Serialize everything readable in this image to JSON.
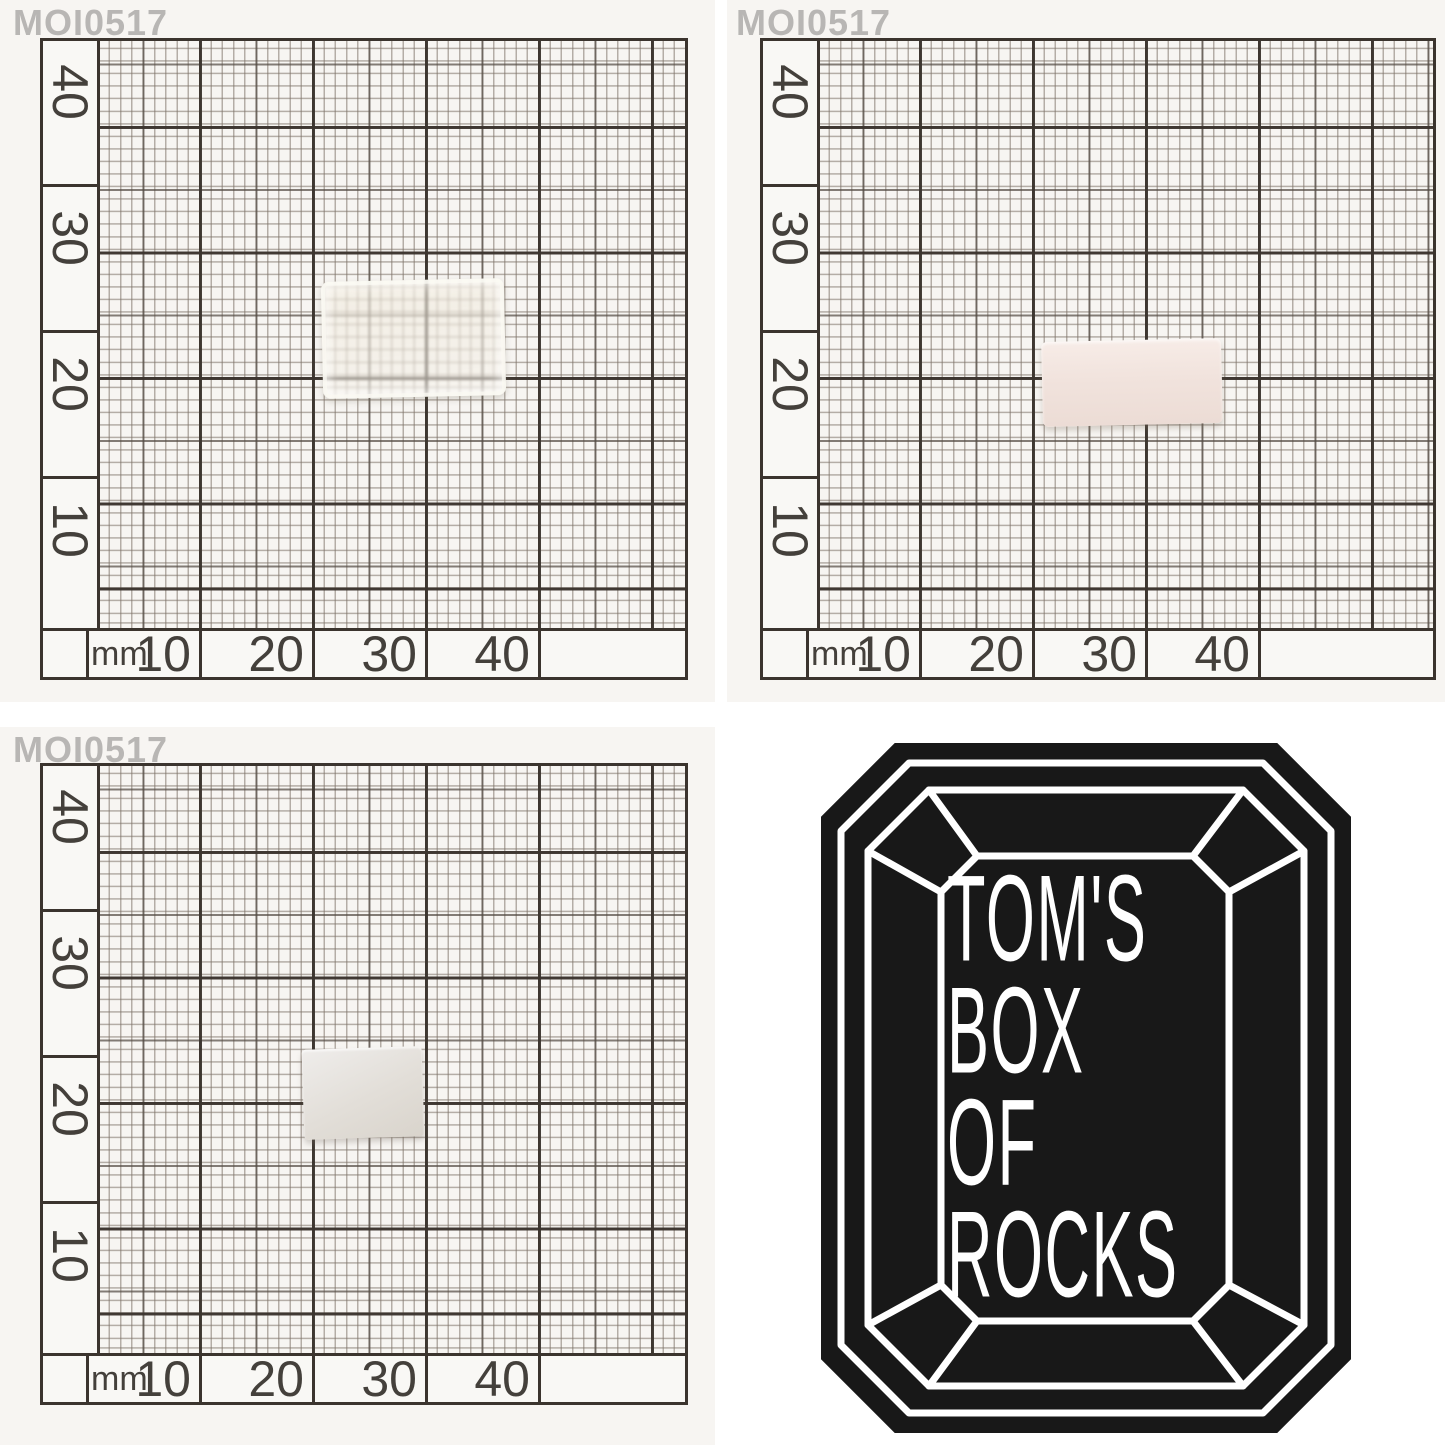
{
  "collage": {
    "panels": [
      {
        "position": "top-left",
        "label": "MOI0517",
        "specimen": {
          "view": "top view, translucent polished sheet",
          "color": "#efe8da"
        }
      },
      {
        "position": "top-right",
        "label": "MOI0517",
        "specimen": {
          "view": "top view, opaque pinkish slab",
          "color": "#f1e3dd"
        }
      },
      {
        "position": "bottom-left",
        "label": "MOI0517",
        "specimen": {
          "view": "side view, pale grey slab",
          "color": "#e0dcd6"
        }
      }
    ],
    "ruler": {
      "unit_label": "mm",
      "x_ticks": [
        "10",
        "20",
        "30",
        "40"
      ],
      "y_ticks": [
        "40",
        "30",
        "20",
        "10"
      ]
    },
    "logo": {
      "lines": [
        "TOM'S",
        "BOX",
        "OF",
        "ROCKS"
      ],
      "shape": "emerald-cut-gem",
      "fill": "#181818",
      "line_color": "#ffffff"
    },
    "colors": {
      "paper": "#f7f5f2",
      "grid_heavy": "#3b342e",
      "grid_fine": "#7d7268",
      "id_label_gray": "#b8b6b4",
      "axis_text": "#44403b"
    }
  }
}
